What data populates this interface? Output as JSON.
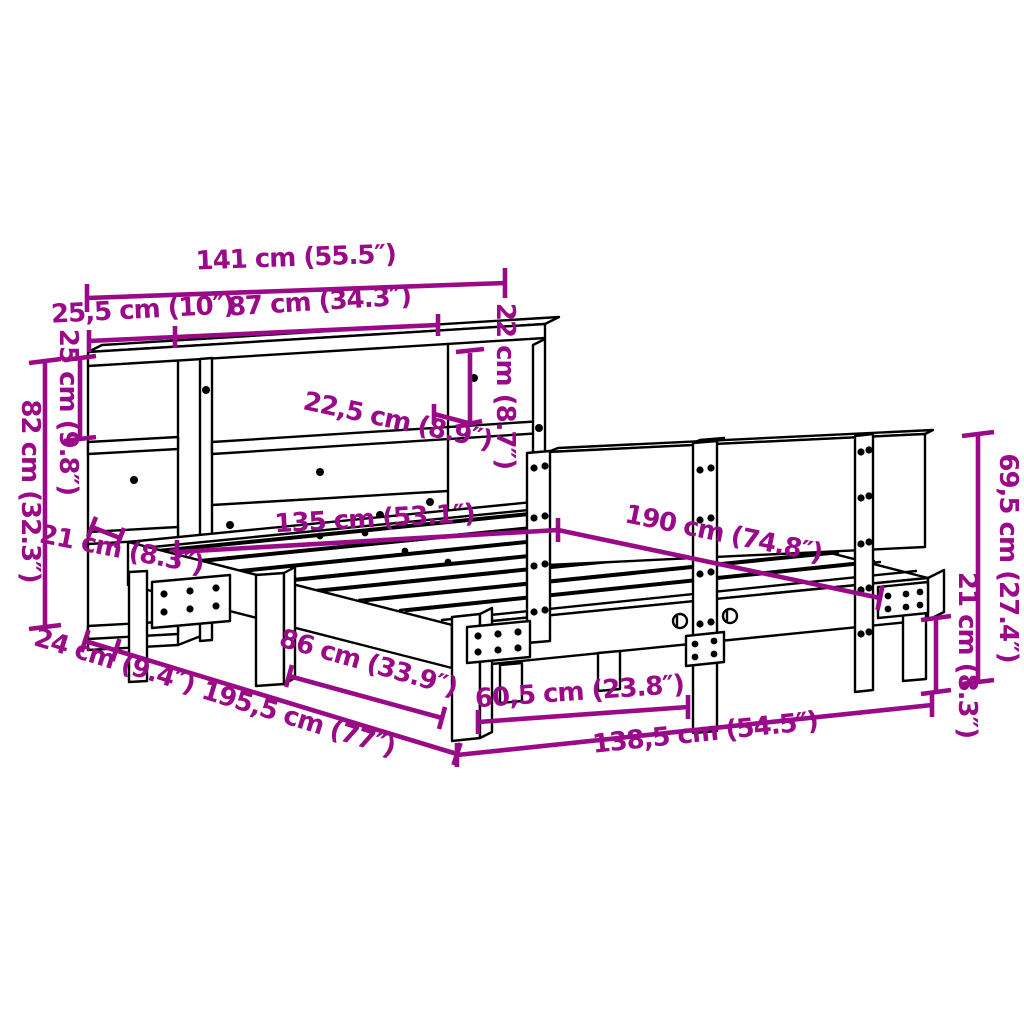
{
  "diagram": {
    "type": "product-dimension-diagram",
    "subject": "bed frame with bookcase headboard",
    "colors": {
      "dimension_accent": "#9a0a88",
      "outline": "#000000",
      "background": "#ffffff"
    },
    "dimensions": [
      {
        "id": "headboard-total-width",
        "label": "141 cm (55.5″)"
      },
      {
        "id": "side-shelf-width",
        "label": "25,5 cm (10″)"
      },
      {
        "id": "main-shelf-width",
        "label": "87 cm (34.3″)"
      },
      {
        "id": "shelf-opening-height",
        "label": "22 cm (8.7″)"
      },
      {
        "id": "shelf-depth",
        "label": "22,5 cm (8.9″)"
      },
      {
        "id": "cubby-height",
        "label": "25 cm (9.8″)"
      },
      {
        "id": "headboard-height",
        "label": "82 cm (32.3″)"
      },
      {
        "id": "rail-board-height",
        "label": "21 cm (8.3″)"
      },
      {
        "id": "headboard-depth",
        "label": "24 cm (9.4″)"
      },
      {
        "id": "total-length",
        "label": "195,5 cm (77″)"
      },
      {
        "id": "leg-spacing-side",
        "label": "86 cm (33.9″)"
      },
      {
        "id": "leg-spacing-foot",
        "label": "60,5 cm (23.8″)"
      },
      {
        "id": "frame-outer-width",
        "label": "138,5 cm (54.5″)"
      },
      {
        "id": "mattress-width",
        "label": "135 cm (53.1″)"
      },
      {
        "id": "mattress-length",
        "label": "190 cm (74.8″)"
      },
      {
        "id": "side-rail-height",
        "label": "69,5 cm (27.4″)"
      },
      {
        "id": "leg-height",
        "label": "21 cm (8.3″)"
      }
    ]
  }
}
